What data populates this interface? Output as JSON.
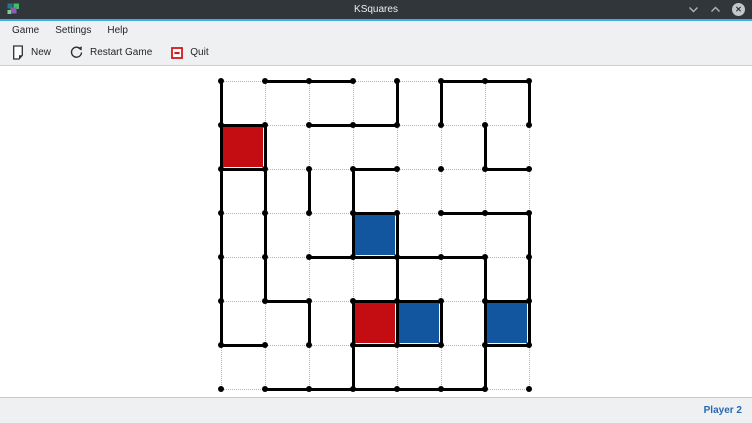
{
  "titlebar": {
    "title": "KSquares",
    "app_icon": "ksquares-icon",
    "window_controls": {
      "minimize_glyph": "⌄",
      "maximize_glyph": "⌃",
      "close_glyph": "✕"
    }
  },
  "menubar": {
    "items": [
      {
        "label": "Game"
      },
      {
        "label": "Settings"
      },
      {
        "label": "Help"
      }
    ]
  },
  "toolbar": {
    "buttons": [
      {
        "label": "New",
        "icon": "new-document-icon"
      },
      {
        "label": "Restart Game",
        "icon": "restart-icon"
      },
      {
        "label": "Quit",
        "icon": "quit-icon"
      }
    ]
  },
  "statusbar": {
    "turn_label": "Player 2",
    "turn_color": "#2668b3"
  },
  "board": {
    "grid_rows": 7,
    "grid_cols": 7,
    "origin_x": 221,
    "origin_y": 81,
    "spacing": 44,
    "line_color": "#000000",
    "open_line_color": "#b1b4b7",
    "player_colors": {
      "red": "#c30d12",
      "blue": "#11569e"
    },
    "horizontal_edges": [
      "0110011",
      "1011000",
      "1001001",
      "0001011",
      "0011110",
      "0101101",
      "1001101",
      "0111110"
    ],
    "vertical_edges": [
      "10001101",
      "11000010",
      "11110000",
      "11011001",
      "11001011",
      "10111111",
      "00010010"
    ],
    "filled_squares": [
      {
        "row": 1,
        "col": 0,
        "player": "red"
      },
      {
        "row": 3,
        "col": 3,
        "player": "blue"
      },
      {
        "row": 5,
        "col": 3,
        "player": "red"
      },
      {
        "row": 5,
        "col": 4,
        "player": "blue"
      },
      {
        "row": 5,
        "col": 6,
        "player": "blue"
      }
    ]
  }
}
